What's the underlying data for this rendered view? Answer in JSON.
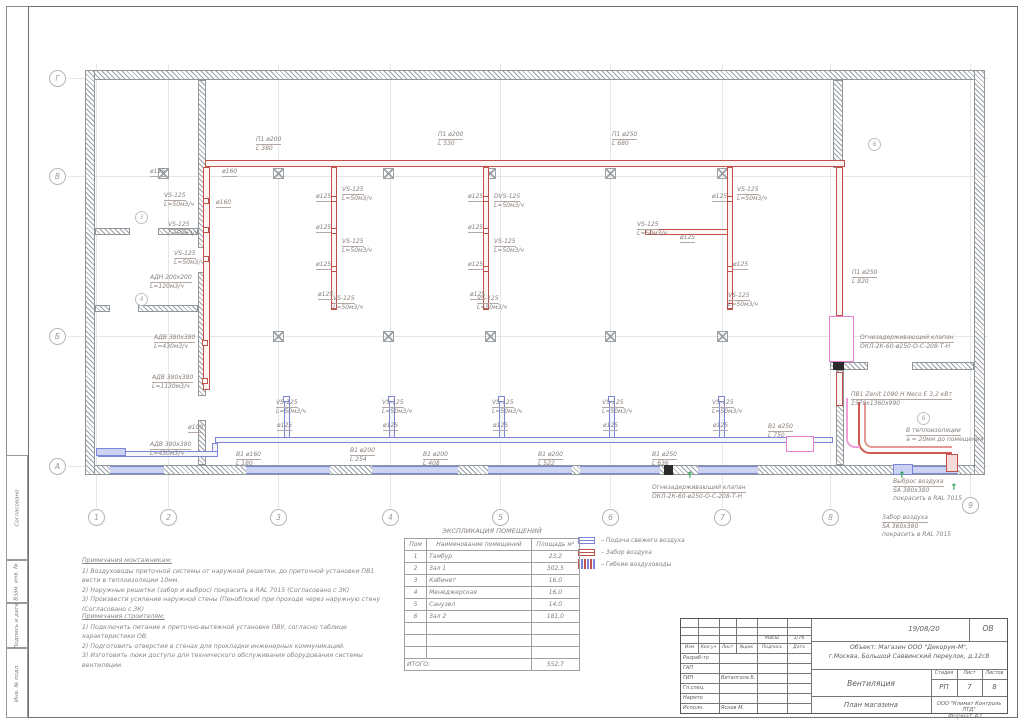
{
  "colors": {
    "supply_red": "#c0504a",
    "return_blue": "#7b86d8",
    "flex_pink": "#e87fd0",
    "arrow_green": "#2ea44f"
  },
  "side_labels": [
    "Согласовано",
    "Взам. инв. №",
    "Подпись и дата",
    "Инв. № подл."
  ],
  "grid": {
    "bottom": [
      {
        "label": "1",
        "x": 96
      },
      {
        "label": "2",
        "x": 168
      },
      {
        "label": "3",
        "x": 278
      },
      {
        "label": "4",
        "x": 390
      },
      {
        "label": "5",
        "x": 500
      },
      {
        "label": "6",
        "x": 610
      },
      {
        "label": "7",
        "x": 722
      },
      {
        "label": "8",
        "x": 830
      },
      {
        "label": "9",
        "x": 970,
        "y": 497
      }
    ],
    "left": [
      {
        "label": "Г",
        "y": 78
      },
      {
        "label": "В",
        "y": 176
      },
      {
        "label": "Б",
        "y": 336
      },
      {
        "label": "А",
        "y": 466
      }
    ]
  },
  "rooms": [
    {
      "n": "3",
      "x": 135,
      "y": 211
    },
    {
      "n": "4",
      "x": 135,
      "y": 293
    },
    {
      "n": "6",
      "x": 868,
      "y": 138
    },
    {
      "n": "6",
      "x": 917,
      "y": 412
    }
  ],
  "annotations": [
    {
      "t": "П1 ø200\nL 380",
      "x": 256,
      "y": 136
    },
    {
      "t": "П1 ø200\nL 530",
      "x": 438,
      "y": 131
    },
    {
      "t": "П1 ø250\nL 680",
      "x": 612,
      "y": 131
    },
    {
      "t": "П1 ø250\nL 820",
      "x": 852,
      "y": 269
    },
    {
      "t": "Огнезадерживающий клапан\nОКЛ-2К-60-ø250-О-С-208-Т-Н",
      "x": 860,
      "y": 334
    },
    {
      "t": "ПВ1 Zenit 1090 H Neco Е 3,2 кВт\n1570х1360х990",
      "x": 851,
      "y": 391
    },
    {
      "t": "В теплоизоляции\nа = 20мм до помещения",
      "x": 906,
      "y": 427
    },
    {
      "t": "Выброс воздуха\nSA 380х380\nпокрасить в RAL 7015",
      "x": 893,
      "y": 478
    },
    {
      "t": "Забор воздуха\nSA 360х380\nпокрасить в RAL 7015",
      "x": 882,
      "y": 514
    },
    {
      "t": "Огнезадерживающий клапан\nОКЛ-2К-60-ø250-О-С-208-Т-Н",
      "x": 652,
      "y": 484
    },
    {
      "t": "VS-125\nL=50м3/ч",
      "x": 164,
      "y": 192
    },
    {
      "t": "VS-125\nL=50м3/ч",
      "x": 168,
      "y": 221
    },
    {
      "t": "VS-125\nL=50м3/ч",
      "x": 174,
      "y": 250
    },
    {
      "t": "АДН 200х200\nL=120м3/ч",
      "x": 150,
      "y": 274
    },
    {
      "t": "АДВ 380х380\nL=430м3/ч",
      "x": 154,
      "y": 334
    },
    {
      "t": "АДВ 380х380\nL=1130м3/ч",
      "x": 152,
      "y": 374
    },
    {
      "t": "АДВ 380х380\nL=430м3/ч",
      "x": 150,
      "y": 441
    },
    {
      "t": "VS-125\nL=50м3/ч",
      "x": 342,
      "y": 186
    },
    {
      "t": "VS-125\nL=50м3/ч",
      "x": 342,
      "y": 238
    },
    {
      "t": "VS-125\nL=50м3/ч",
      "x": 333,
      "y": 295
    },
    {
      "t": "DVS-125\nL=50м3/ч",
      "x": 494,
      "y": 193
    },
    {
      "t": "VS-125\nL=50м3/ч",
      "x": 494,
      "y": 238
    },
    {
      "t": "VS-125\nL=50м3/ч",
      "x": 477,
      "y": 295
    },
    {
      "t": "VS-125\nL=50м3/ч",
      "x": 737,
      "y": 186
    },
    {
      "t": "VS-125\nL=50м3/ч",
      "x": 637,
      "y": 221
    },
    {
      "t": "VS-125\nL=50м3/ч",
      "x": 728,
      "y": 292
    },
    {
      "t": "VS-125\nL=50м3/ч",
      "x": 276,
      "y": 399
    },
    {
      "t": "VS-125\nL=50м3/ч",
      "x": 382,
      "y": 399
    },
    {
      "t": "VS-125\nL=50м3/ч",
      "x": 492,
      "y": 399
    },
    {
      "t": "VS-125\nL=50м3/ч",
      "x": 602,
      "y": 399
    },
    {
      "t": "VS-125\nL=50м3/ч",
      "x": 712,
      "y": 399
    },
    {
      "t": "В1 ø160\nL 180",
      "x": 236,
      "y": 451
    },
    {
      "t": "В1 ø200\nL 254",
      "x": 350,
      "y": 447
    },
    {
      "t": "В1 ø200\nL 408",
      "x": 423,
      "y": 451
    },
    {
      "t": "В1 ø200\nL 522",
      "x": 538,
      "y": 451
    },
    {
      "t": "В1 ø250\nL 636",
      "x": 652,
      "y": 451
    },
    {
      "t": "В1 ø250\nL 750",
      "x": 768,
      "y": 423
    },
    {
      "t": "ø125",
      "x": 150,
      "y": 168
    },
    {
      "t": "ø160",
      "x": 222,
      "y": 168
    },
    {
      "t": "ø160",
      "x": 216,
      "y": 199
    },
    {
      "t": "ø125",
      "x": 316,
      "y": 193
    },
    {
      "t": "ø125",
      "x": 316,
      "y": 224
    },
    {
      "t": "ø125",
      "x": 316,
      "y": 261
    },
    {
      "t": "ø125",
      "x": 318,
      "y": 291
    },
    {
      "t": "ø125",
      "x": 468,
      "y": 193
    },
    {
      "t": "ø125",
      "x": 468,
      "y": 224
    },
    {
      "t": "ø125",
      "x": 468,
      "y": 261
    },
    {
      "t": "ø125",
      "x": 470,
      "y": 291
    },
    {
      "t": "ø125",
      "x": 712,
      "y": 193
    },
    {
      "t": "ø125",
      "x": 680,
      "y": 234
    },
    {
      "t": "ø125",
      "x": 733,
      "y": 261
    },
    {
      "t": "ø100",
      "x": 188,
      "y": 424
    },
    {
      "t": "ø125",
      "x": 277,
      "y": 422
    },
    {
      "t": "ø125",
      "x": 383,
      "y": 422
    },
    {
      "t": "ø125",
      "x": 493,
      "y": 422
    },
    {
      "t": "ø125",
      "x": 603,
      "y": 422
    },
    {
      "t": "ø125",
      "x": 713,
      "y": 422
    }
  ],
  "legend": {
    "items": [
      {
        "symbol": "supply",
        "label": "Подача свежего воздуха"
      },
      {
        "symbol": "intake",
        "label": "Забор воздуха"
      },
      {
        "symbol": "flex",
        "label": "Гибкие воздуховоды"
      }
    ]
  },
  "room_table": {
    "title": "ЭКСПЛИКАЦИЯ ПОМЕЩЕНИЙ",
    "headers": [
      "Пом",
      "Наименование помещений",
      "Площадь м²"
    ],
    "rows": [
      [
        "1",
        "Тамбур",
        "23,2"
      ],
      [
        "2",
        "Зал 1",
        "302,5"
      ],
      [
        "3",
        "Кабинет",
        "16,0"
      ],
      [
        "4",
        "Менеджерская",
        "16,0"
      ],
      [
        "5",
        "Санузел",
        "14,0"
      ],
      [
        "6",
        "Зал 2",
        "181,0"
      ],
      [
        "",
        "",
        ""
      ],
      [
        "",
        "",
        ""
      ],
      [
        "",
        "",
        ""
      ]
    ],
    "total_label": "ИТОГО:",
    "total": "552,7"
  },
  "notes_installers": {
    "title": "Примечания монтажникам:",
    "lines": [
      "1) Воздуховоды приточной системы от наружной решетки, до приточной установки ПВ1",
      "вести в теплоизоляции 10мм.",
      "2) Наружные решетки (забор и выброс) покрасить в RAL 7015 (Согласовано с ЗК)",
      "3) Произвести усиление наружной стены (Пеноблоки) при проходе через наружную стену",
      "(Согласовано с ЗК)"
    ]
  },
  "notes_builders": {
    "title": "Примечания строителям:",
    "lines": [
      "1) Подключить питание к приточно-вытяжной установке ПВУ, согласно таблице",
      "характеристики ОВ.",
      "2) Подготовить отверстия в стенах для прокладки инженерных коммуникаций.",
      "3) Изготовить люки доступа для технического обслуживания оборудования системы",
      "вентиляции."
    ]
  },
  "titleblock": {
    "date": "19/08/20",
    "code": "ОВ",
    "object_line1": "Объект: Магазин ООО \"Декорум-М\",",
    "object_line2": "г.Москва, Большой Саввинский переулок, д.12с8",
    "doc_title": "Вентиляция",
    "stage_label": "Стадия",
    "sheet_label": "Лист",
    "sheets_label": "Листов",
    "stage": "РП",
    "sheet": "7",
    "sheets": "8",
    "drawing_title": "План магазина",
    "company": "ООО \"Климат Контроль ЛТД\"",
    "scale_label": "Масш",
    "scale": "1/76",
    "header_cols": [
      "Изм",
      "Кол.уч",
      "Лист",
      "№док",
      "Подпись",
      "Дата"
    ],
    "rows": [
      {
        "role": "Разраб-то",
        "name": ""
      },
      {
        "role": "ГАП",
        "name": ""
      },
      {
        "role": "ГИП",
        "name": "Виталгола Б."
      },
      {
        "role": "Гл.спец.",
        "name": ""
      },
      {
        "role": "Нармто",
        "name": ""
      },
      {
        "role": "Исполн.",
        "name": "Яснов М."
      }
    ],
    "format": "Формат А2"
  }
}
